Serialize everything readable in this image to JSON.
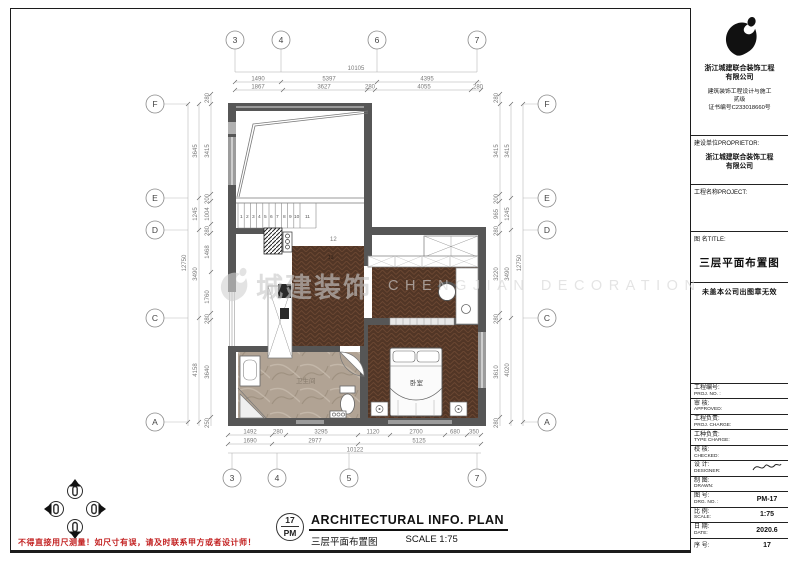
{
  "colors": {
    "wall": "#565656",
    "wall_window": "#9c9c9c",
    "wood": "#523626",
    "marble": "#b1a394",
    "warning_red": "#c32222",
    "watermark_gray": "#cccccc"
  },
  "title_block": {
    "company_name_1": "浙江城建联合装饰工程",
    "company_name_2": "有限公司",
    "cert_1": "建筑装饰工程设计与施工",
    "cert_2": "贰级",
    "cert_3": "证书编号C233018660号",
    "proprietor_label": "建设单位PROPRIETOR:",
    "proprietor_value_1": "浙江城建联合装饰工程",
    "proprietor_value_2": "有限公司",
    "project_label": "工程名称PROJECT:",
    "title_label": "图  名TITLE:",
    "drawing_title": "三层平面布置图",
    "seal_note": "未盖本公司出图章无效",
    "rows": [
      {
        "cn": "工程编号:",
        "en": "PROJ. NO. :",
        "value": ""
      },
      {
        "cn": "审  核:",
        "en": "APPROVED:",
        "value": ""
      },
      {
        "cn": "工程负责:",
        "en": "PROJ. CHARGE:",
        "value": ""
      },
      {
        "cn": "工种负责:",
        "en": "TYPE CHARGE:",
        "value": ""
      },
      {
        "cn": "校  核:",
        "en": "CHECKED:",
        "value": ""
      },
      {
        "cn": "设  计:",
        "en": "DESIGNER:",
        "value": ""
      },
      {
        "cn": "制  图:",
        "en": "DRAWN:",
        "value": ""
      },
      {
        "cn": "图  号:",
        "en": "DRG. NO. :",
        "value": "PM-17"
      },
      {
        "cn": "比  例:",
        "en": "SCALE:",
        "value": "1:75"
      },
      {
        "cn": "日  期:",
        "en": "DATE:",
        "value": "2020.6"
      },
      {
        "cn": "序  号:",
        "en": "",
        "value": "17"
      }
    ]
  },
  "footer": {
    "circle_top": "17",
    "circle_bottom": "PM",
    "title_en": "ARCHITECTURAL  INFO.  PLAN",
    "title_cn": "三层平面布置图",
    "scale": "SCALE 1:75"
  },
  "warning_note": "不得直接用尺测量！如尺寸有误，请及时联系甲方或者设计师！",
  "watermark": {
    "cn": "城建装饰",
    "en": "CHENGJIAN DECORATION"
  },
  "grid": {
    "top": [
      "3",
      "4",
      "6",
      "7"
    ],
    "bottom": [
      "3",
      "4",
      "5",
      "7"
    ],
    "left": [
      "F",
      "E",
      "D",
      "C",
      "A"
    ],
    "right": [
      "F",
      "E",
      "D",
      "C",
      "A"
    ]
  },
  "dimensions": {
    "top": {
      "overall": "10105",
      "row2": [
        "1490",
        "5397",
        "4395"
      ],
      "row3": [
        "1867",
        "3627",
        "280",
        "4055",
        "280"
      ]
    },
    "bottom": {
      "row1": [
        "1492",
        "280",
        "3295",
        "1120",
        "2700",
        "680",
        "350"
      ],
      "row2": [
        "1690",
        "2977",
        "5125"
      ],
      "overall": "10122"
    },
    "left": {
      "overall": "12750",
      "mid": [
        "3645",
        "1245",
        "3490",
        "4158"
      ],
      "inner": [
        "280",
        "3415",
        "200",
        "1004",
        "280",
        "1468",
        "1760",
        "280",
        "3640",
        "250"
      ]
    },
    "right": {
      "overall": "12750",
      "mid": [
        "3415",
        "1245",
        "3490",
        "4020"
      ],
      "inner": [
        "280",
        "3415",
        "200",
        "965",
        "280",
        "3220",
        "280",
        "3610",
        "280"
      ]
    }
  },
  "plan": {
    "stair_numbers": [
      "1",
      "2",
      "3",
      "4",
      "5",
      "6",
      "7",
      "8",
      "9",
      "10",
      "11"
    ],
    "landing_label": "12",
    "floor_label": "13",
    "bedroom_label": "卧室",
    "bathroom_label": "卫生间"
  }
}
